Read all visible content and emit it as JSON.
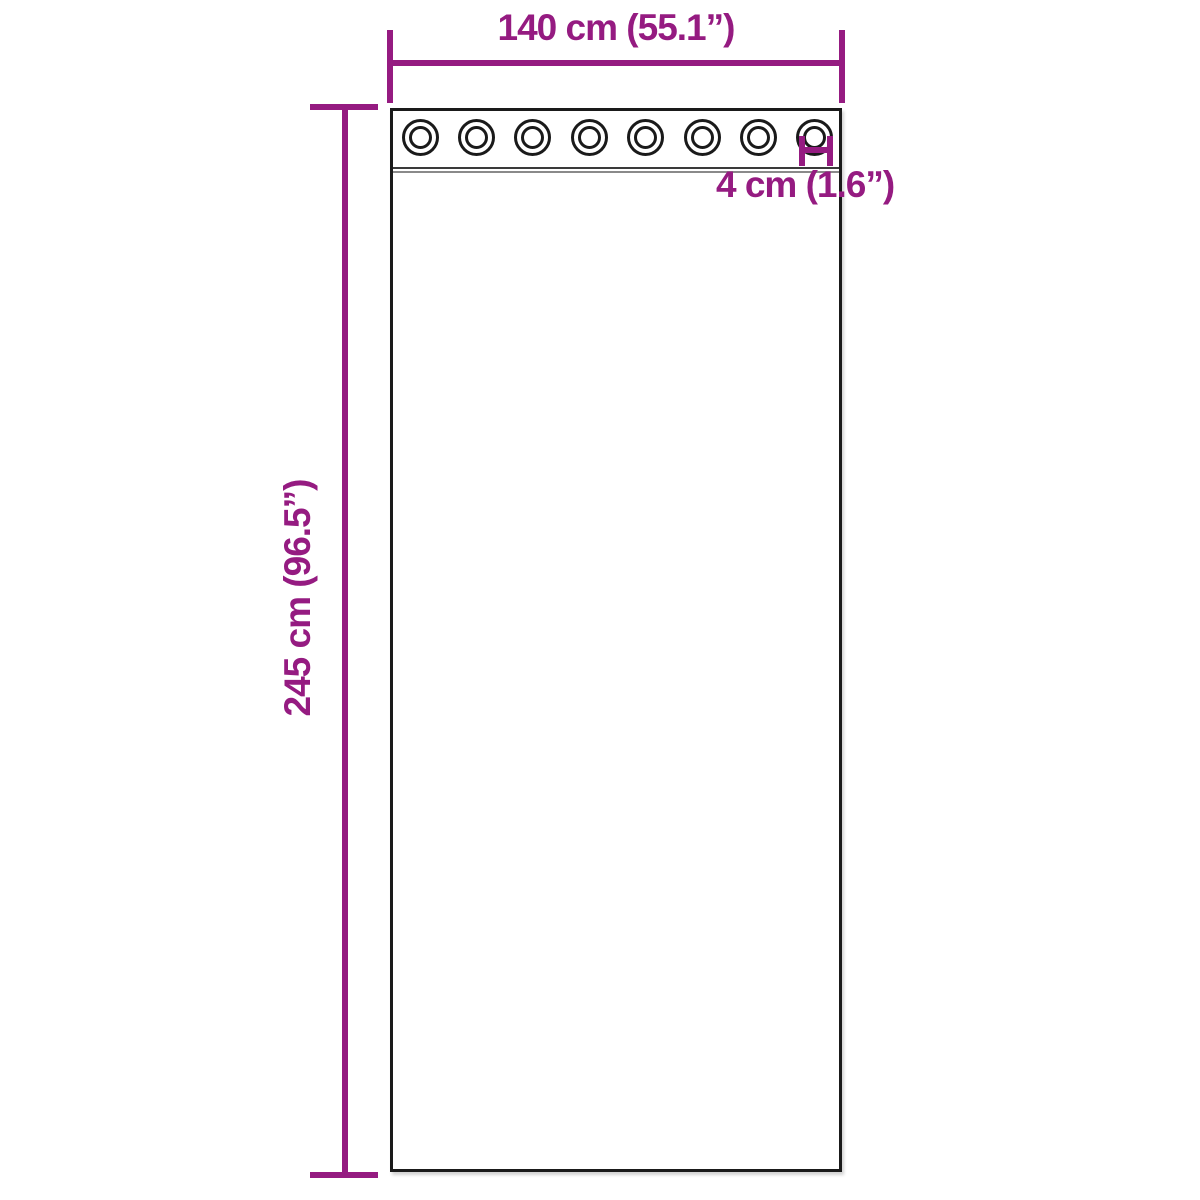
{
  "colors": {
    "accent": "#951b81",
    "outline": "#1a1a1a",
    "band_top": "#3a3a3a",
    "band_bottom": "#8a8a8a",
    "background": "#ffffff"
  },
  "labels": {
    "width": "140 cm (55.1”)",
    "height": "245 cm (96.5”)",
    "grommet_inner_diameter": "4 cm (1.6”)"
  },
  "grommet_count": 8
}
